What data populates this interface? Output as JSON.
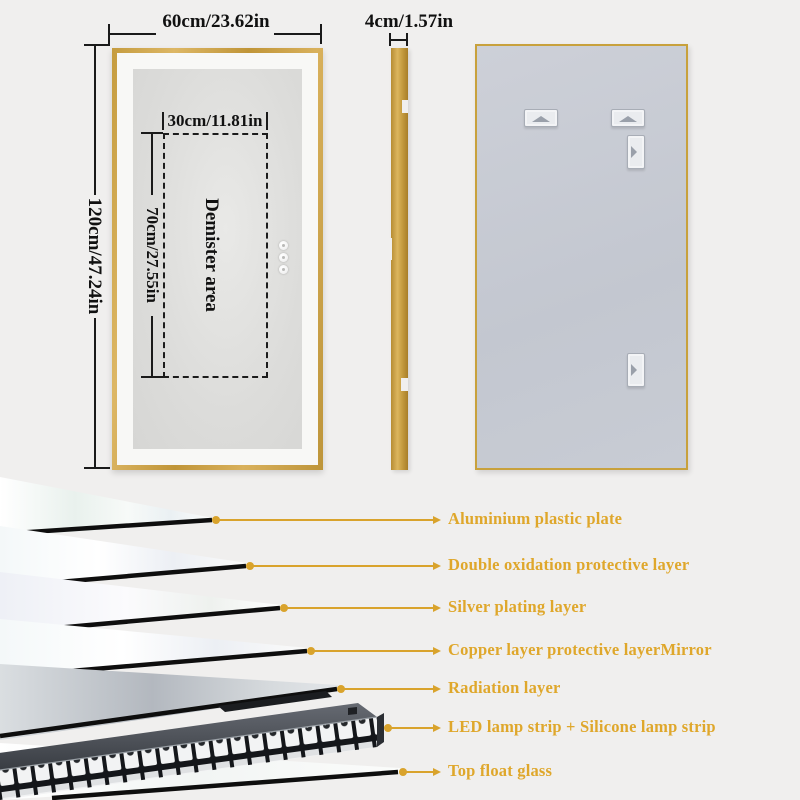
{
  "colors": {
    "background": "#f0efee",
    "frame_gold": "#c9a23c",
    "callout_gold": "#dba62c",
    "back_panel_gray": "#c7cad2",
    "dimension_ink": "#1a1a1a"
  },
  "front_view": {
    "width_label": "60cm/23.62in",
    "height_label": "120cm/47.24in",
    "demister_area_label": "Demister area",
    "demister_width_label": "30cm/11.81in",
    "demister_height_label": "70cm/27.55in",
    "touch_button_count": 3
  },
  "side_view": {
    "thickness_label": "4cm/1.57in"
  },
  "back_view": {
    "bracket_count": 4
  },
  "layer_callouts": [
    {
      "label": "Aluminium plastic plate"
    },
    {
      "label": "Double oxidation protective layer"
    },
    {
      "label": "Silver plating layer"
    },
    {
      "label": "Copper layer protective layerMirror"
    },
    {
      "label": "Radiation layer"
    },
    {
      "label": "LED lamp strip + Silicone lamp strip"
    },
    {
      "label": "Top float glass"
    }
  ]
}
